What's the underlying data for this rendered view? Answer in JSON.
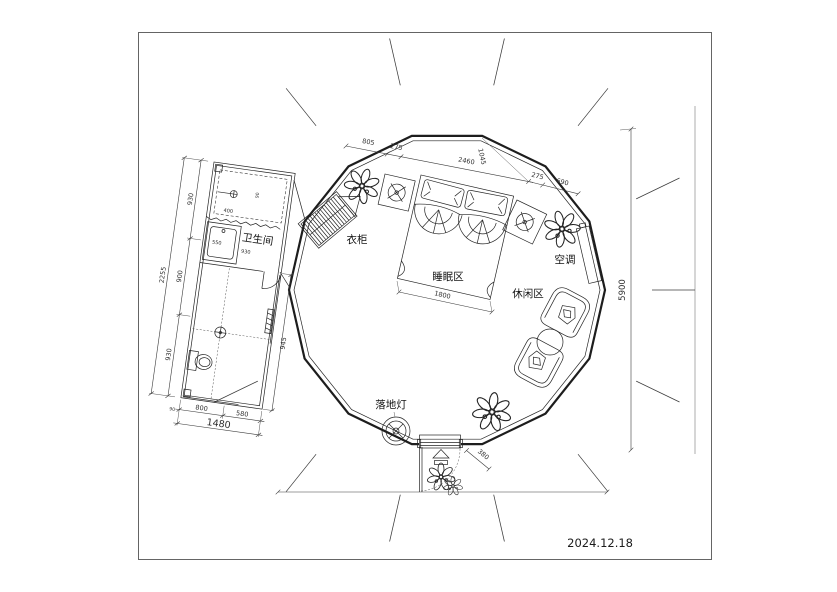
{
  "date": "2024.12.18",
  "labels": {
    "bathroom": "卫生间",
    "wardrobe": "衣柜",
    "sleeping_area": "睡眠区",
    "leisure_area": "休闲区",
    "air_conditioner": "空调",
    "floor_lamp": "落地灯"
  },
  "dimensions": {
    "top_chain": [
      "805",
      "275",
      "2460",
      "1045"
    ],
    "top_chain_right": [
      "275",
      "690"
    ],
    "height_overall": "5900",
    "bed_width": "1800",
    "door_side": "380",
    "bathroom": {
      "left_overall": "2255",
      "left_segments": [
        "930",
        "900",
        "930"
      ],
      "bottom_segments": [
        "800",
        "580"
      ],
      "bottom_small": "90",
      "bottom_overall": "1480",
      "right": "945",
      "vanity": "550",
      "inner_width": "930",
      "shower_depth": "400",
      "shower_small": "90"
    }
  },
  "colors": {
    "line": "#1f1f1f",
    "dim_text": "#333333",
    "frame": "#a6a6a6",
    "black_fill": "#141414"
  }
}
